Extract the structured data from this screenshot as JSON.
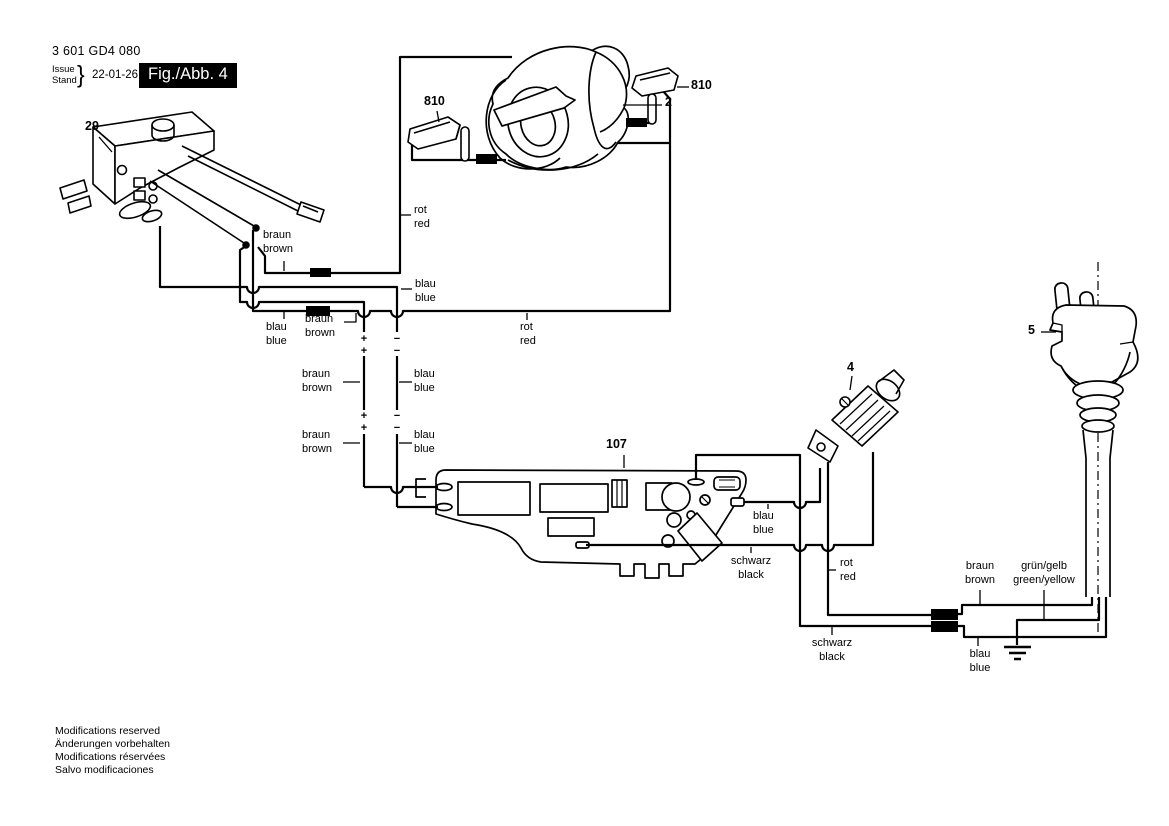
{
  "header": {
    "part_number": "3 601 GD4 080",
    "issue_stand": "Issue\nStand",
    "brace": "}",
    "date": "22-01-26",
    "figure_label": "Fig./Abb. 4"
  },
  "footer": {
    "text": "Modifications reserved\nÄnderungen vorbehalten\nModifications réservées\nSalvo modificaciones"
  },
  "part_labels": {
    "switch": "29",
    "field_coil": "2",
    "brush_left": "810",
    "brush_right": "810",
    "suppressor": "4",
    "plug": "5",
    "pcb": "107"
  },
  "wire_labels": {
    "rot_red_top": "rot\nred",
    "braun_brown_switch": "braun\nbrown",
    "blau_blue_corner": "blau\nblue",
    "blau_blue_left": "blau\nblue",
    "braun_brown_crimp": "braun\nbrown",
    "rot_red_long": "rot\nred",
    "braun_brown_arm1": "braun\nbrown",
    "blau_blue_arm1": "blau\nblue",
    "braun_brown_arm2": "braun\nbrown",
    "blau_blue_arm2": "blau\nblue",
    "blau_blue_pcb": "blau\nblue",
    "schwarz_black_pcb": "schwarz\nblack",
    "rot_red_right": "rot\nred",
    "braun_brown_mains": "braun\nbrown",
    "gruen_gelb_mains": "grün/gelb\ngreen/yellow",
    "schwarz_black_bottom": "schwarz\nblack",
    "blau_blue_mains": "blau\nblue"
  },
  "symbols": {
    "plus": "+",
    "minus": "−"
  },
  "colors": {
    "line": "#000000",
    "background": "#ffffff",
    "figure_box_bg": "#000000",
    "figure_box_text": "#ffffff"
  }
}
